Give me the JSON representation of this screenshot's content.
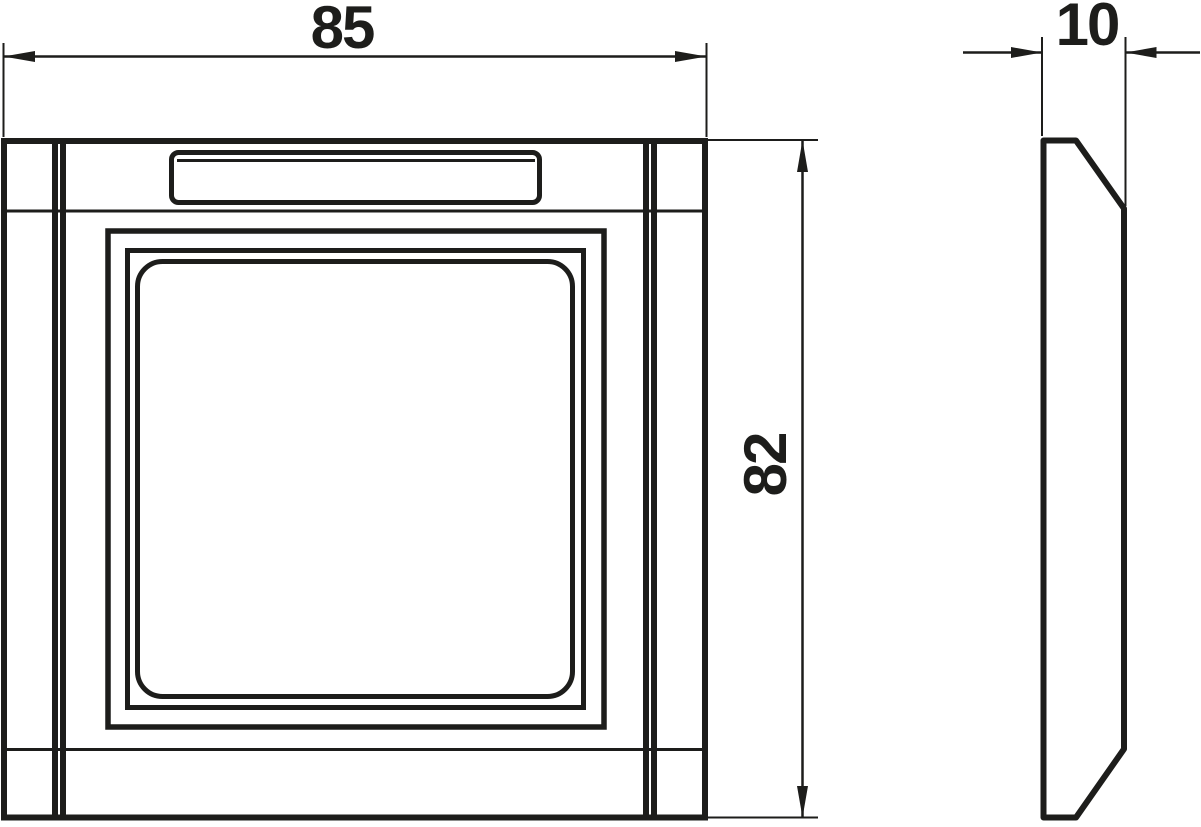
{
  "drawing": {
    "background_color": "#ffffff",
    "line_color": "#1d1d1b",
    "labels": {
      "width": "85",
      "height": "82",
      "depth": "10"
    }
  }
}
